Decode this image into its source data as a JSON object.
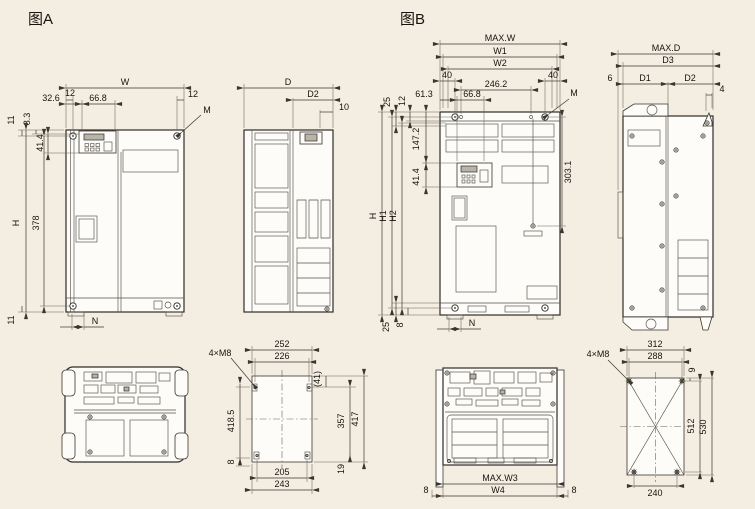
{
  "colors": {
    "background": "#f4ede1",
    "ink": "#2f2b28"
  },
  "figA": {
    "title": "图A",
    "front": {
      "w": "W",
      "m12l": "12",
      "m12r": "12",
      "d326": "32.6",
      "d668": "66.8",
      "m": "M",
      "d11t": "11",
      "d83": "8.3",
      "d414": "41.4",
      "h": "H",
      "d378": "378",
      "d11b": "11",
      "n": "N"
    },
    "side": {
      "d": "D",
      "d2": "D2",
      "d10": "10"
    },
    "pattern": {
      "callout": "4×M8",
      "d252": "252",
      "d226": "226",
      "d41": "(41)",
      "d4185": "418.5",
      "d357": "357",
      "d417": "417",
      "d8": "8",
      "d205": "205",
      "d19": "19",
      "d243": "243"
    }
  },
  "figB": {
    "title": "图B",
    "front": {
      "maxw": "MAX.W",
      "w1": "W1",
      "w2": "W2",
      "m40l": "40",
      "m40r": "40",
      "d2462": "246.2",
      "d613": "61.3",
      "d668": "66.8",
      "m": "M",
      "d25t": "25",
      "d12": "12",
      "d1472": "147.2",
      "d414": "41.4",
      "h": "H",
      "h1": "H1",
      "h2": "H2",
      "d3031": "303.1",
      "d25b": "25",
      "d8": "8",
      "n": "N"
    },
    "side": {
      "maxd": "MAX.D",
      "d3": "D3",
      "d6": "6",
      "d1": "D1",
      "d2": "D2",
      "d4": "4"
    },
    "bottom": {
      "maxw3": "MAX.W3",
      "w4": "W4",
      "d8l": "8",
      "d8r": "8"
    },
    "pattern": {
      "callout": "4×M8",
      "d312": "312",
      "d288": "288",
      "d9": "9",
      "d512": "512",
      "d530": "530",
      "d240": "240"
    }
  }
}
